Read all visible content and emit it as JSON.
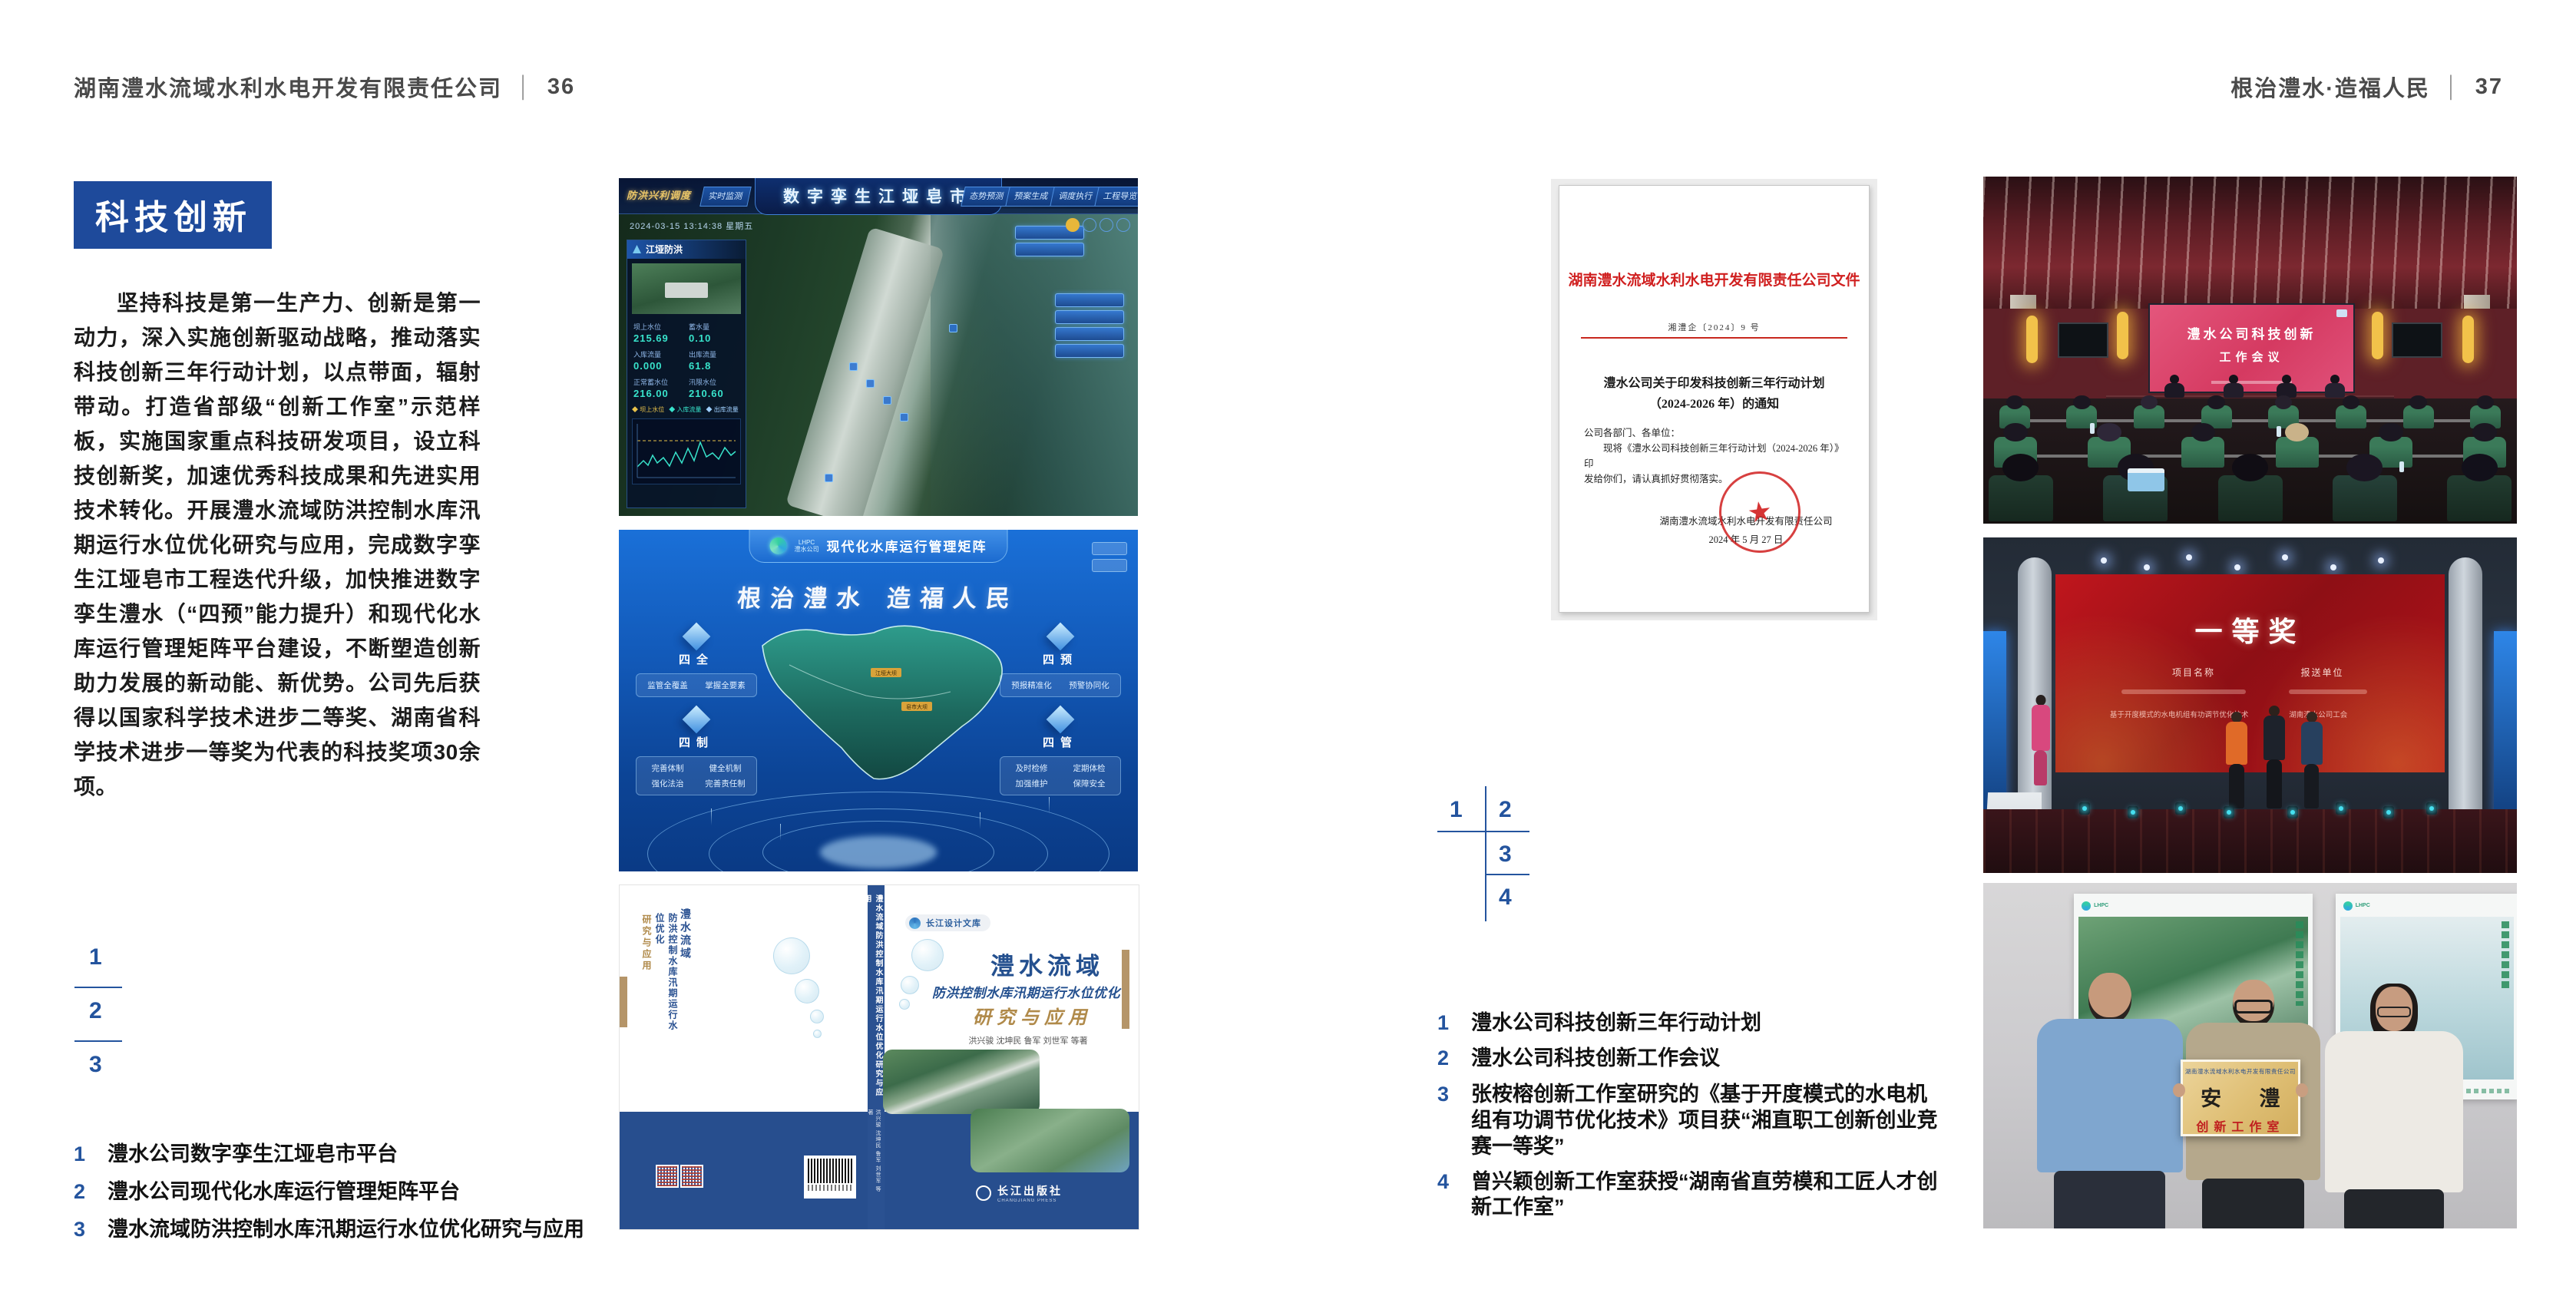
{
  "colors": {
    "accent_blue": "#1e4a9b",
    "index_blue": "#24549e",
    "header_gray": "#4a4a4a",
    "doc_red": "#d01f1f",
    "cover_blue": "#274e8e",
    "gold": "#b08a4a"
  },
  "page_left": {
    "header": {
      "company": "湖南澧水流域水利水电开发有限责任公司",
      "separator": "│",
      "page_number": "36"
    },
    "section_title": "科技创新",
    "body_paragraph": "坚持科技是第一生产力、创新是第一动力，深入实施创新驱动战略，推动落实科技创新三年行动计划，以点带面，辐射带动。打造省部级“创新工作室”示范样板，实施国家重点科技研发项目，设立科技创新奖，加速优秀科技成果和先进实用技术转化。开展澧水流域防洪控制水库汛期运行水位优化研究与应用，完成数字孪生江垭皂市工程迭代升级，加快推进数字孪生澧水（“四预”能力提升）和现代化水库运行管理矩阵平台建设，不断塑造创新助力发展的新动能、新优势。公司先后获得以国家科学技术进步二等奖、湖南省科学技术进步一等奖为代表的科技奖项30余项。",
    "figure_index": [
      "1",
      "2",
      "3"
    ],
    "captions": [
      {
        "num": "1",
        "text": "澧水公司数字孪生江垭皂市平台"
      },
      {
        "num": "2",
        "text": "澧水公司现代化水库运行管理矩阵平台"
      },
      {
        "num": "3",
        "text": "澧水流域防洪控制水库汛期运行水位优化研究与应用"
      }
    ],
    "figure1": {
      "top_title": "数字孪生江垭皂市",
      "corner_label": "防洪兴利调度",
      "tabs_left": [
        "实时监测",
        "洪水预报",
        "防汛预警"
      ],
      "tabs_right": [
        "态势预测",
        "预案生成",
        "调度执行",
        "工程导览"
      ],
      "timestamp": "2024-03-15 13:14:38 星期五",
      "panel_title": "江垭防洪",
      "stats": [
        {
          "label": "坝上水位",
          "value": "215.69"
        },
        {
          "label": "蓄水量",
          "value": "0.10"
        },
        {
          "label": "入库流量",
          "value": "0.000"
        },
        {
          "label": "出库流量",
          "value": "61.8"
        },
        {
          "label": "正常蓄水位",
          "value": "216.00"
        },
        {
          "label": "汛限水位",
          "value": "210.60"
        }
      ],
      "chart_legend": [
        "◆ 坝上水位",
        "◆ 入库流量",
        "◆ 出库流量"
      ]
    },
    "figure2": {
      "logo_abbr": "LHPC",
      "logo_text": "澧水公司",
      "title": "现代化水库运行管理矩阵",
      "slogan": "根治澧水 造福人民",
      "corner_groups": [
        {
          "label": "四全",
          "items": [
            "监管全覆盖",
            "掌握全要素"
          ]
        },
        {
          "label": "四预",
          "items": [
            "预报精准化",
            "预警协同化"
          ]
        },
        {
          "label": "四制",
          "items": [
            "完善体制",
            "健全机制",
            "强化法治",
            "完善责任制"
          ]
        },
        {
          "label": "四管",
          "items": [
            "及时检修",
            "定期体检",
            "加强维护",
            "保障安全"
          ]
        }
      ],
      "map_markers": [
        "江垭大坝",
        "皂市大坝"
      ]
    },
    "figure3": {
      "series_badge": "长江设计文库",
      "title": "澧水流域",
      "subtitle": "防洪控制水库汛期运行水位优化",
      "title_accent": "研究与应用",
      "authors": "洪兴骏 沈坤民 鲁军 刘世军 等著",
      "publisher": "长江出版社",
      "publisher_en": "CHANGJIANG PRESS",
      "spine_title": "澧水流域防洪控制水库汛期运行水位优化研究与应用"
    }
  },
  "page_right": {
    "header": {
      "motto": "根治澧水·造福人民",
      "separator": "│",
      "page_number": "37"
    },
    "document": {
      "red_header": "湖南澧水流域水利水电开发有限责任公司文件",
      "doc_number": "湘澧企〔2024〕9 号",
      "title_line1": "澧水公司关于印发科技创新三年行动计划",
      "title_line2": "（2024-2026 年）的通知",
      "salutation": "公司各部门、各单位：",
      "body_line1": "现将《澧水公司科技创新三年行动计划（2024-2026 年）》印",
      "body_line2": "发给你们，请认真抓好贯彻落实。",
      "signature": "湖南澧水流域水利水电开发有限责任公司",
      "date": "2024 年 5 月 27 日"
    },
    "figure_index": [
      "1",
      "2",
      "3",
      "4"
    ],
    "captions": [
      {
        "num": "1",
        "text": "澧水公司科技创新三年行动计划"
      },
      {
        "num": "2",
        "text": "澧水公司科技创新工作会议"
      },
      {
        "num": "3",
        "text": "张桉榕创新工作室研究的《基于开度模式的水电机组有功调节优化技术》项目获“湘直职工创新创业竞赛一等奖”"
      },
      {
        "num": "4",
        "text": "曾兴颖创新工作室获授“湖南省直劳模和工匠人才创新工作室”"
      }
    ],
    "photo_meeting": {
      "screen_line1": "澧水公司科技创新",
      "screen_line2": "工作会议"
    },
    "photo_award": {
      "screen_title": "一等奖",
      "column_project": "项目名称",
      "column_unit": "报送单位",
      "entry_project": "基于开度模式的水电机组有功调节优化技术",
      "entry_unit": "湖南澧水公司工会"
    },
    "photo_plaque": {
      "plaque_header": "湖南澧水流域水利水电开发有限责任公司",
      "plaque_calligraphy": "安 澧",
      "plaque_title": "创新工作室"
    }
  }
}
